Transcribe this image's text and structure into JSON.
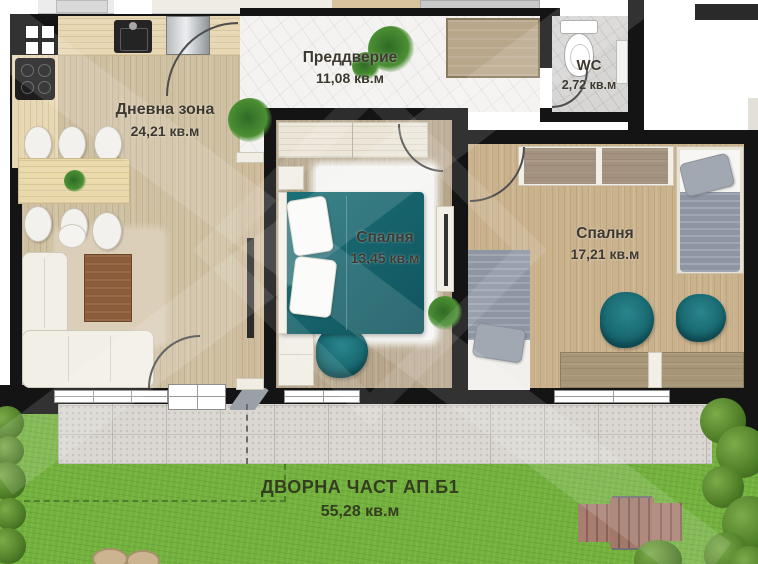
{
  "plan_title": "Floor plan apartment B1 with yard",
  "rooms": {
    "entry": {
      "name": "Преддверие",
      "area": "11,08 кв.м"
    },
    "wc": {
      "name": "WC",
      "area": "2,72 кв.м"
    },
    "living": {
      "name": "Дневна зона",
      "area": "24,21 кв.м"
    },
    "bedroom1": {
      "name": "Спалня",
      "area": "13,45 кв.м"
    },
    "bedroom2": {
      "name": "Спалня",
      "area": "17,21 кв.м"
    },
    "yard": {
      "name": "ДВОРНА ЧАСТ АП.Б1",
      "area": "55,28 кв.м"
    }
  },
  "colors": {
    "wall": "#141414",
    "accent_teal": "#136069",
    "grass_green": "#73b13d",
    "terrace_gray": "#dbd8d3",
    "living_floor": "#cfc0a2",
    "bedroom1_floor": "#b7a68c",
    "bedroom2_floor": "#cab28d",
    "entry_tile": "#f4f3f1",
    "wc_tile": "#d7d6d4",
    "deck_wood": "#a87e70",
    "label_text": "#3e3930",
    "yard_label_text": "#333e1f"
  }
}
